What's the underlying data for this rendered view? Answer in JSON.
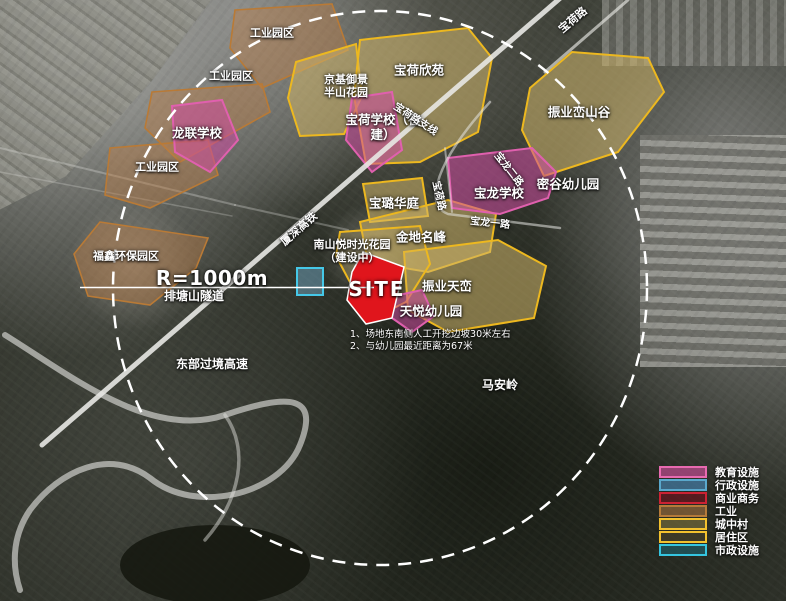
{
  "colors": {
    "education": "#e060ae",
    "administrative": "#5aa8cc",
    "commercial": "#cc2233",
    "industry": "#b97a36",
    "urban_village": "#f2c12e",
    "residential": "#f2c12e",
    "municipal": "#45c8e8",
    "site_red": "#e0151c",
    "circle_white": "#ffffff"
  },
  "map": {
    "site_label": "SITE",
    "radius_label": "R=1000m",
    "notes": [
      "1、场地东南侧人工开挖边坡30米左右",
      "2、与幼儿园最近距离为67米"
    ],
    "labels": {
      "industrial_park_1": "工业园区",
      "industrial_park_2": "工业园区",
      "industrial_park_3": "工业园区",
      "longlian_school": "龙联学校",
      "jingji_yujing": "京基御景\n半山花园",
      "baohe_school": "宝荷学校（在建）",
      "baohe_xinyuan": "宝荷欣苑",
      "zhenye_luanshangu": "振业峦山谷",
      "migu_kindergarten": "密谷幼儿园",
      "baolu_huating": "宝璐华庭",
      "baolong_school": "宝龙学校",
      "jindi_mingfeng": "金地名峰",
      "nanshan_yue": "南山悦时光花园\n（建设中）",
      "zhenye_tianluan": "振业天峦",
      "tianyue_kindergarten": "天悦幼儿园",
      "fuxin_park": "福鑫环保园区",
      "paitangshan_tunnel": "排塘山隧道",
      "eastern_bypass": "东部过境高速",
      "maanling": "马安岭",
      "xiashen_railway": "厦深高铁",
      "baohe_road_top": "宝荷路",
      "baohe_branch_road": "宝荷路支线",
      "baohe_road_west": "宝荷路",
      "baolong_road_1": "宝龙一路",
      "baolong_road_2": "宝龙二路"
    },
    "legend": {
      "items": [
        {
          "label": "教育设施",
          "fill": "#c84c96",
          "border": "#e86ab0"
        },
        {
          "label": "行政设施",
          "fill": "#4682af",
          "border": "#5aa8cc"
        },
        {
          "label": "商业商务",
          "fill": "#6e141e",
          "border": "#cc2233"
        },
        {
          "label": "工业",
          "fill": "#96693c",
          "border": "#b57a3a"
        },
        {
          "label": "城中村",
          "fill": "#786e3c",
          "border": "#f2c12e"
        },
        {
          "label": "居住区",
          "fill": "#464128",
          "border": "#f2c12e"
        },
        {
          "label": "市政设施",
          "fill": "#1e5f69",
          "border": "#35c5e0"
        }
      ]
    }
  }
}
